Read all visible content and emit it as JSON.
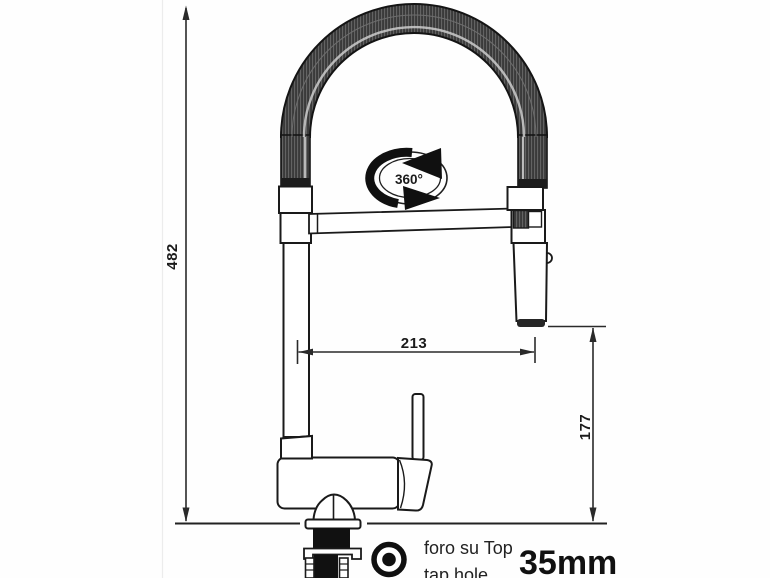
{
  "meta": {
    "type": "technical-drawing",
    "subject": "kitchen mixer tap with pull-down spring spout and dimensions"
  },
  "dimensions": {
    "overall_height": "482",
    "spout_reach": "213",
    "outlet_height": "177"
  },
  "rotation": {
    "label": "360°"
  },
  "annotation": {
    "hole_note_line1": "foro su Top",
    "hole_note_line2": "tap hole",
    "hole_size": "35mm"
  },
  "icons": {
    "tap_hole_icon": "concentric-target-icon",
    "rotation_icon": "circular-360-arrows-icon"
  },
  "colors": {
    "line": "#1f1f1f",
    "coil_dark": "#3a3a3a",
    "background": "#ffffff"
  }
}
